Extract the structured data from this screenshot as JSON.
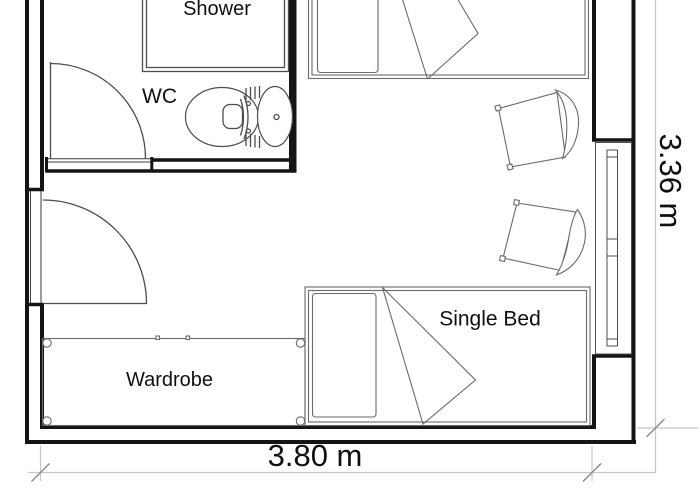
{
  "plan": {
    "labels": {
      "shower": "Shower",
      "wc": "WC",
      "single_bed": "Single Bed",
      "wardrobe": "Wardrobe"
    },
    "dimensions": {
      "width_label": "3.80 m",
      "height_label": "3.36 m"
    },
    "colors": {
      "wall": "#141414",
      "fixture": "#4d4d4d",
      "furniture": "#6a6a6a",
      "dimension_line": "#c6c6c6",
      "tick": "#8a8a8a",
      "text": "#101010",
      "background": "#ffffff"
    }
  }
}
